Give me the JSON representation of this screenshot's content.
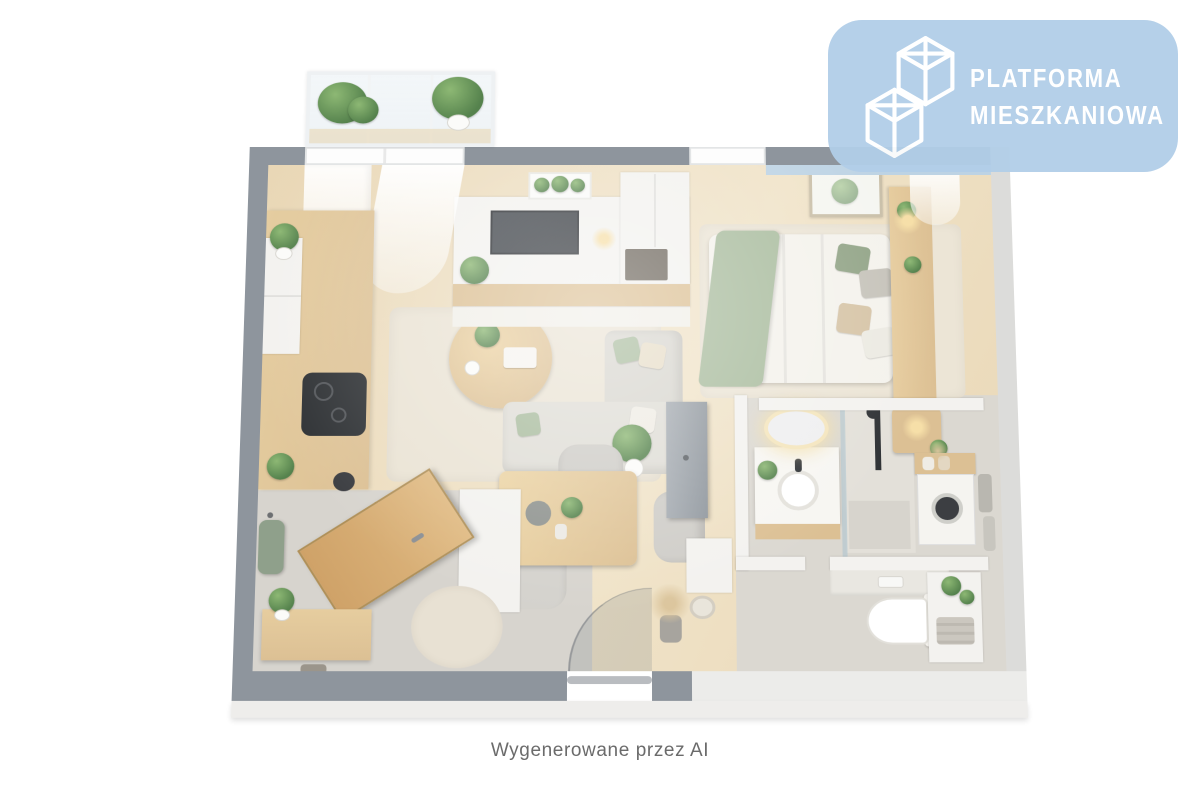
{
  "logo": {
    "line1": "PLATFORMA",
    "line2": "MIESZKANIOWA",
    "icon": "isometric-cubes-building-icon"
  },
  "caption": {
    "text": "Wygenerowane przez AI"
  },
  "colors": {
    "page_bg": "#ffffff",
    "badge_blue": "#b1cee8",
    "logo_text": "#ffffff",
    "caption_gray": "#6b6b6b",
    "wall_gray": "#8e959d",
    "wall_light": "#dcdcda",
    "wall_white": "#f3f2ef",
    "wall_face": "#eeedeb",
    "bedroom_accent_blue": "#bdd3e4",
    "floor_wood": "#e9d7b6",
    "floor_wood_light": "#f0e3c8",
    "tile_gray": "#d7d4ce",
    "bath_tile": "#dbd8d1",
    "rug_beige": "#eae3d4",
    "sofa_gray": "#d8d6cf",
    "sage_green": "#a9bc9e",
    "plant_green": "#55824d",
    "wood_furniture": "#dcc094",
    "door_wood": "#cfa268",
    "tv_dark": "#33373c",
    "fixture_black": "#2e3134",
    "lamp_glow": "#f6dfa8"
  }
}
